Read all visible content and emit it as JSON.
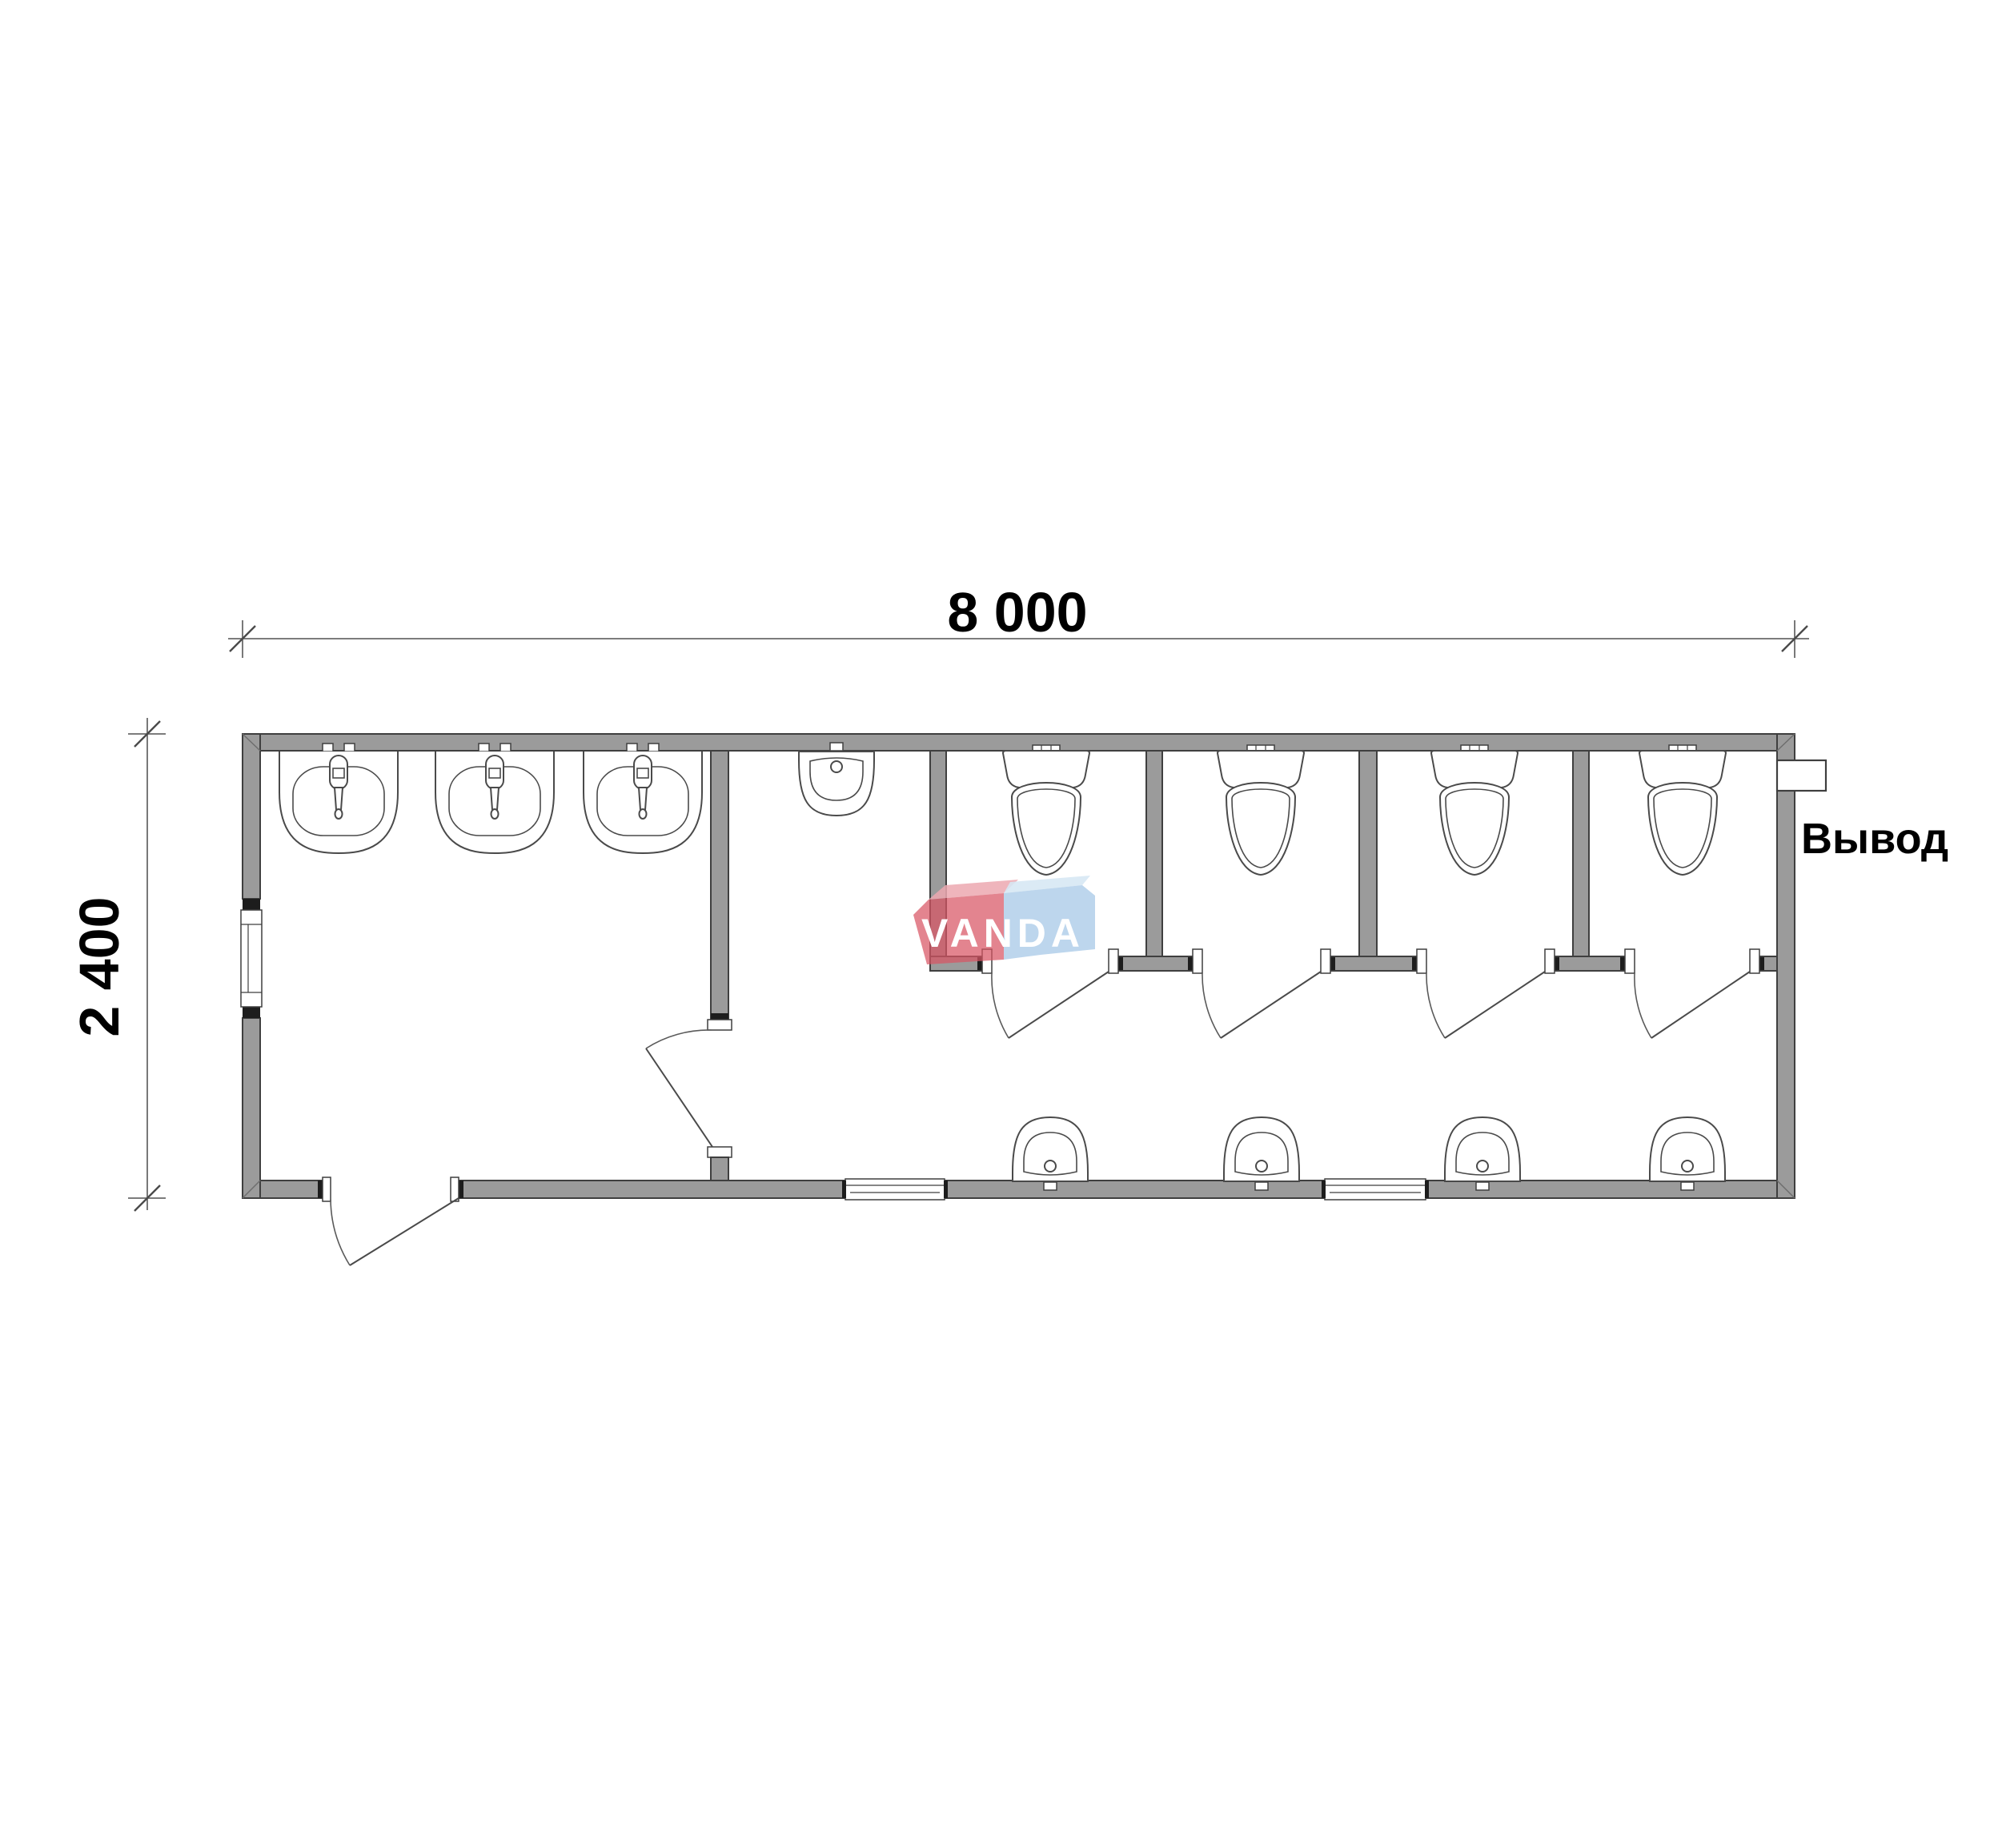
{
  "drawing_type": "floor-plan",
  "dimensions": {
    "width_label": "8 000",
    "height_label": "2 400"
  },
  "labels": {
    "outlet": "Вывод"
  },
  "watermark": {
    "text": "VANDA",
    "red": "#d85464",
    "red_top": "#eca8b0",
    "blue": "#aacbe8",
    "blue_top": "#d6e7f4"
  },
  "colors": {
    "background": "#ffffff",
    "wall_fill": "#9b9b9b",
    "wall_outline": "#3f3f3f",
    "fixture_line": "#4a4a4a",
    "dimension_line": "#6a6a6a",
    "text": "#000000"
  },
  "fixtures": {
    "sink_count": 3,
    "toilet_count": 4,
    "urinal_count": 5,
    "stall_count": 4,
    "window_count": 3,
    "door_count": 6
  }
}
